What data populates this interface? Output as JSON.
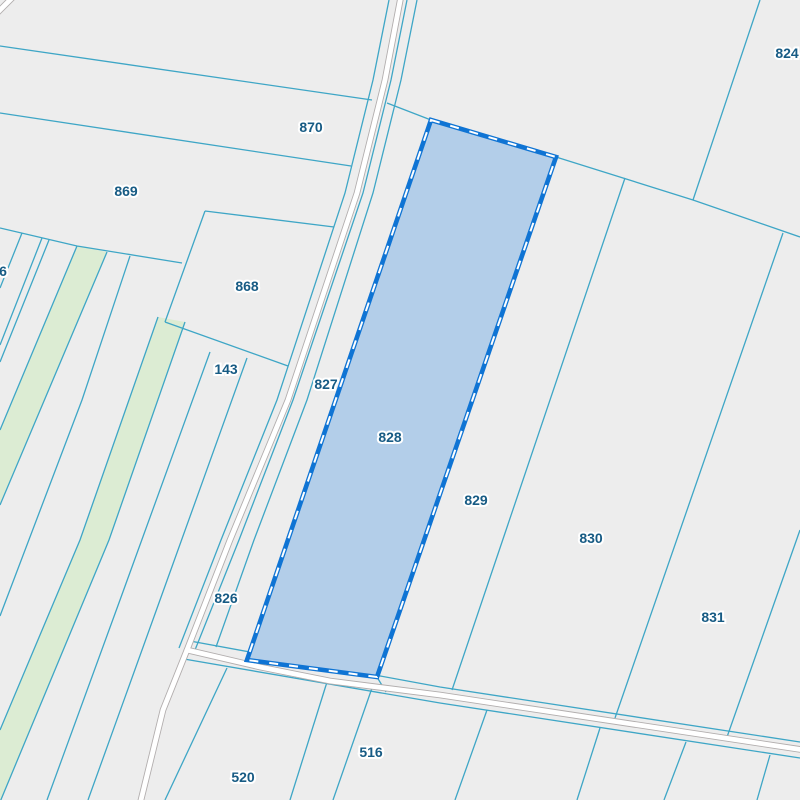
{
  "app": {
    "name": "cadastral-parcel-map-viewer"
  },
  "map": {
    "background": "#ededed",
    "boundary_line": "#3ea6c6",
    "label_color": "#175b84",
    "green_fill": "#dcecd3",
    "road_fill": "#ffffff",
    "road_casing": "#b2aeae",
    "selection_fill": "#b3cee9",
    "selection_border": "#0f74d4",
    "selection_dash": "#ffffff"
  },
  "selected_parcel": {
    "label": "828"
  },
  "parcel_labels": [
    {
      "label": "6",
      "x": 3,
      "y": 276,
      "selected": false
    },
    {
      "label": "870",
      "x": 311,
      "y": 132,
      "selected": false
    },
    {
      "label": "869",
      "x": 126,
      "y": 196,
      "selected": false
    },
    {
      "label": "868",
      "x": 247,
      "y": 291,
      "selected": false
    },
    {
      "label": "143",
      "x": 226,
      "y": 374,
      "selected": false
    },
    {
      "label": "827",
      "x": 326,
      "y": 389,
      "selected": false
    },
    {
      "label": "828",
      "x": 390,
      "y": 442,
      "selected": true
    },
    {
      "label": "826",
      "x": 226,
      "y": 603,
      "selected": false
    },
    {
      "label": "824",
      "x": 787,
      "y": 58,
      "selected": false
    },
    {
      "label": "829",
      "x": 476,
      "y": 505,
      "selected": false
    },
    {
      "label": "830",
      "x": 591,
      "y": 543,
      "selected": false
    },
    {
      "label": "831",
      "x": 713,
      "y": 622,
      "selected": false
    },
    {
      "label": "516",
      "x": 371,
      "y": 757,
      "selected": false
    },
    {
      "label": "520",
      "x": 243,
      "y": 782,
      "selected": false
    }
  ]
}
